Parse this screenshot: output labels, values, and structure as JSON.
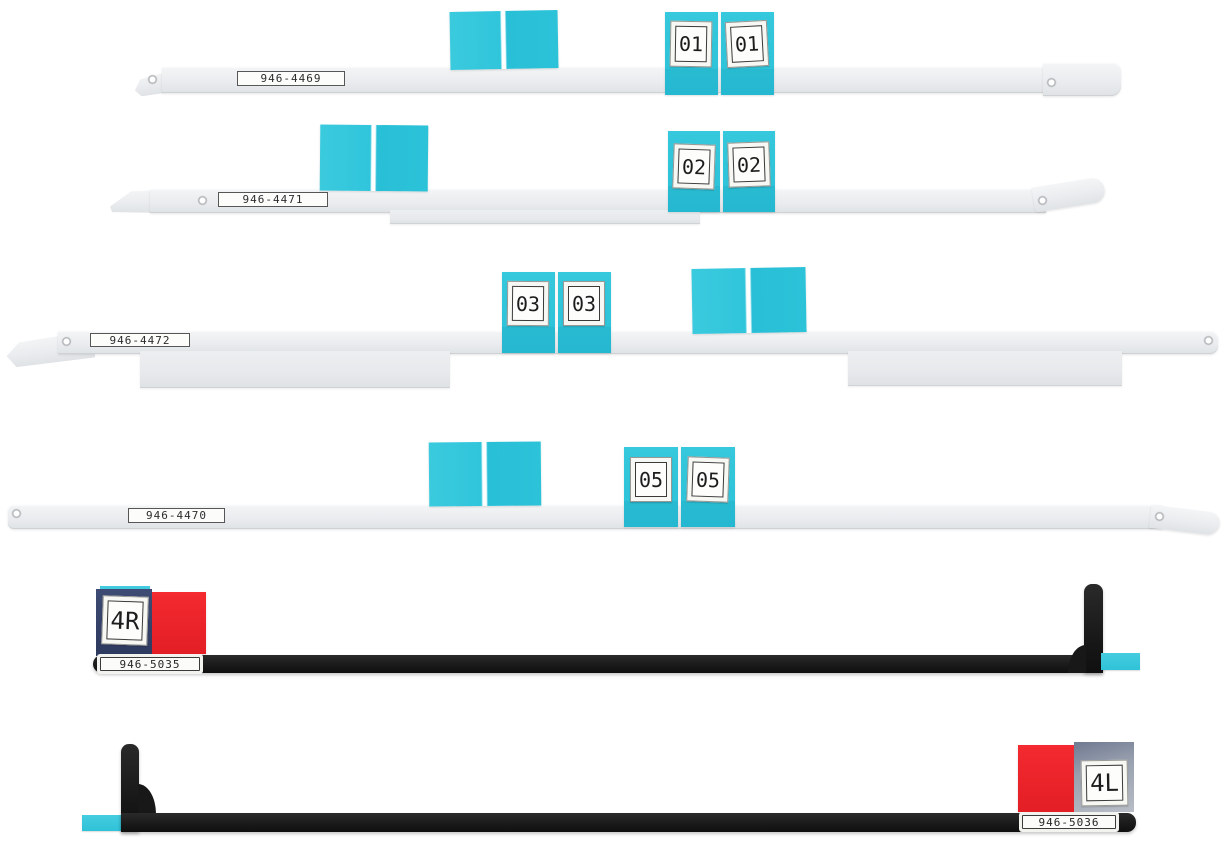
{
  "colors": {
    "background": "#ffffff",
    "cyan_tab": "#2cc3da",
    "strip_gray": "#eaecef",
    "black_strip": "#181818",
    "red_tab": "#ee2227",
    "navy_tab": "#36426b",
    "slate_tab": "#9aa3b3"
  },
  "strips": [
    {
      "part_number": "946-4469",
      "tab_labels": [
        "01",
        "01"
      ]
    },
    {
      "part_number": "946-4471",
      "tab_labels": [
        "02",
        "02"
      ]
    },
    {
      "part_number": "946-4472",
      "tab_labels": [
        "03",
        "03"
      ]
    },
    {
      "part_number": "946-4470",
      "tab_labels": [
        "05",
        "05"
      ]
    },
    {
      "part_number": "946-5035",
      "tab_labels": [
        "4R"
      ]
    },
    {
      "part_number": "946-5036",
      "tab_labels": [
        "4L"
      ]
    }
  ]
}
